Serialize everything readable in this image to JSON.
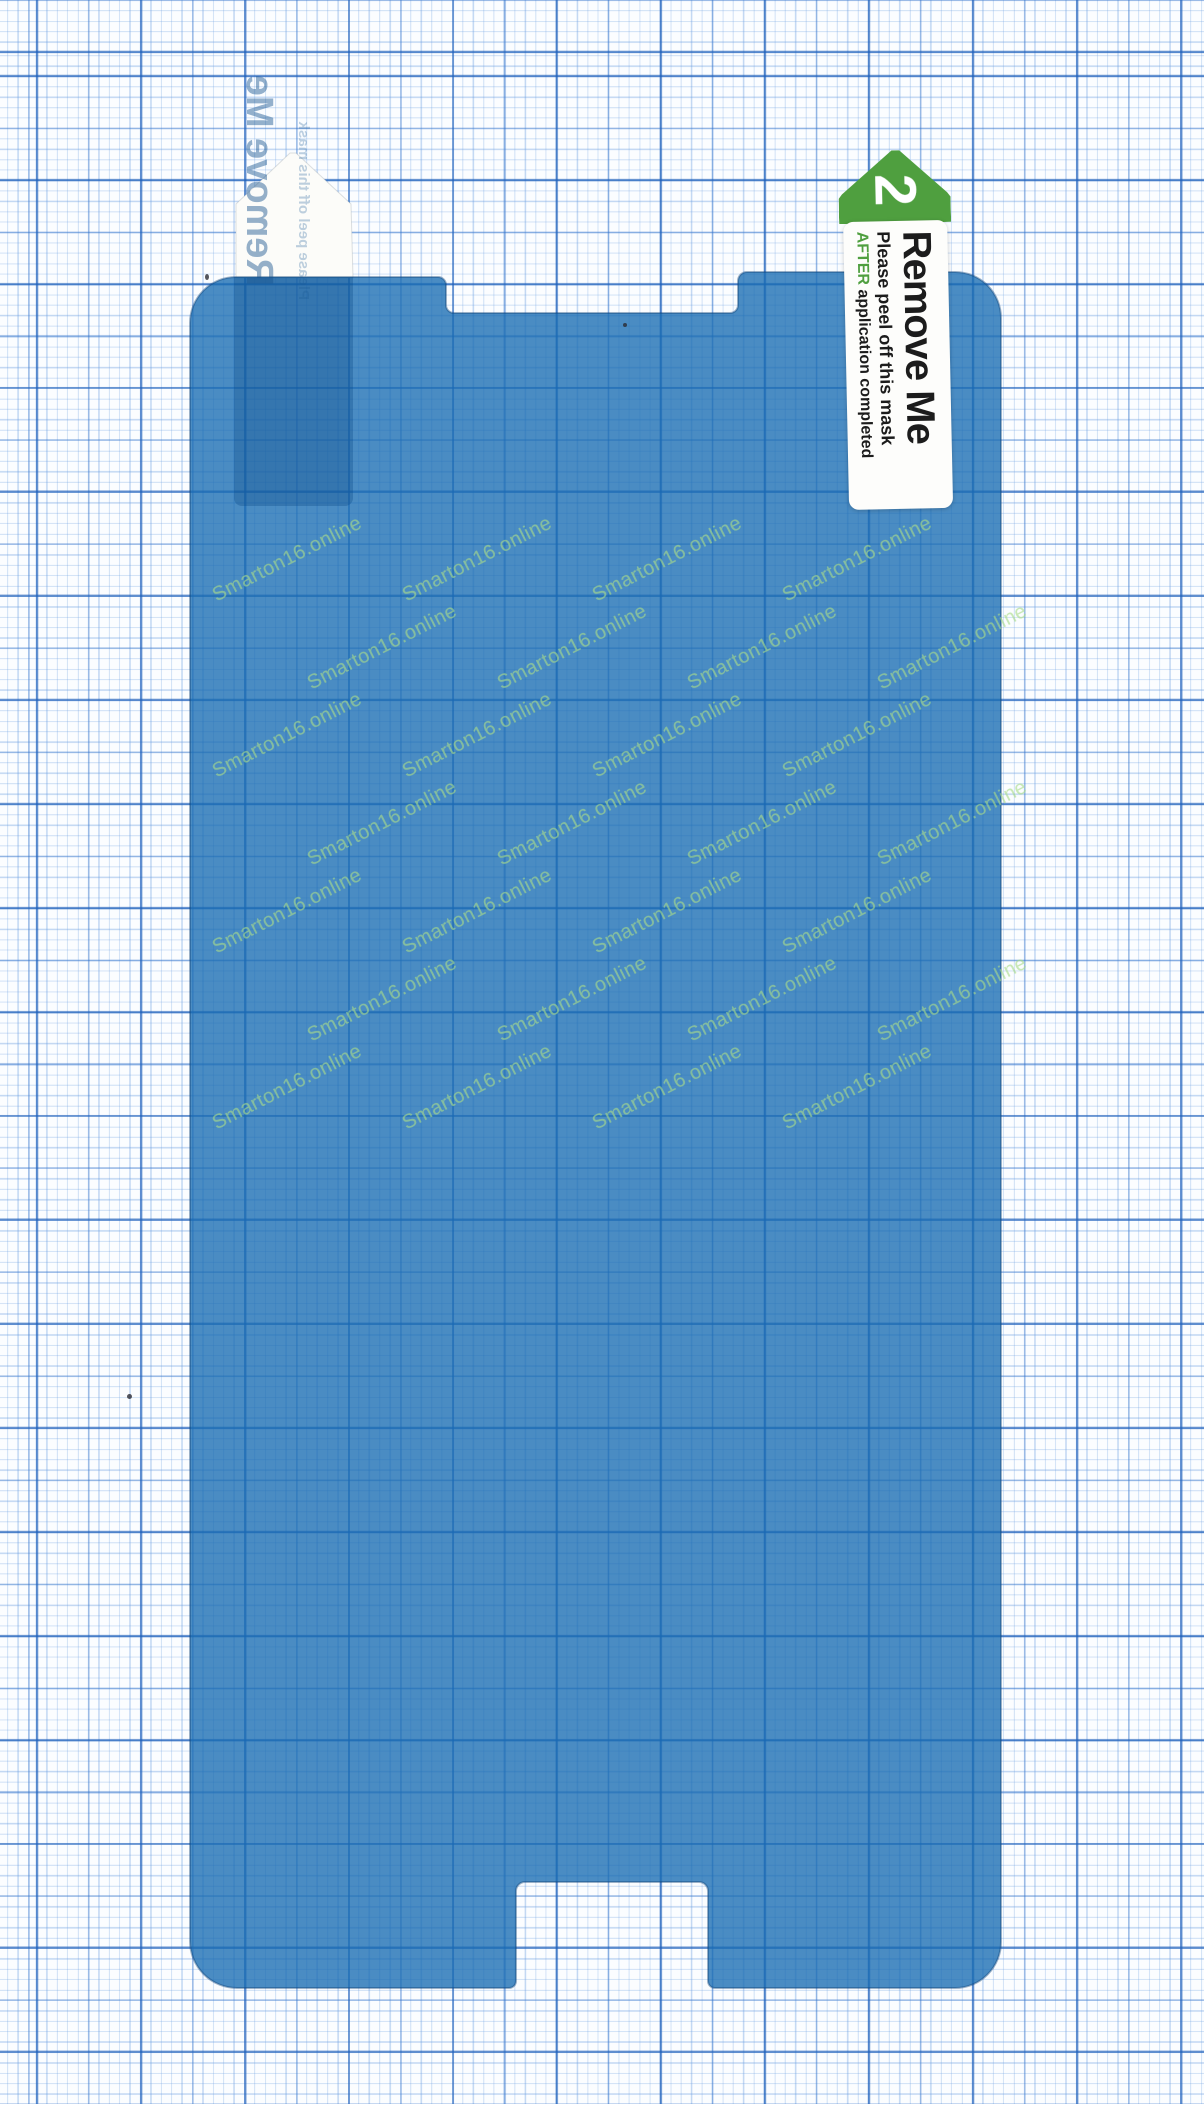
{
  "colors": {
    "paper": "#fbfdff",
    "grid_blue": "#2f6fba",
    "film_blue": "#4a8dc4",
    "tab_green": "#4f9f3f",
    "watermark_green": "#a9dc8a",
    "label_white": "#fdfdfb",
    "peel_tab_white": "#fcfcf9"
  },
  "film": {
    "watermark": "Smarton16.online"
  },
  "peel_tab_step2": {
    "step_number": "2",
    "title": "Remove Me",
    "instruction_line": "Please peel off this mask",
    "emphasis_word": "AFTER",
    "instruction_tail": "application completed"
  },
  "peel_tab_step1_mirrored": {
    "title": "Remove Me",
    "instruction_line": "Please peel off this mask"
  }
}
